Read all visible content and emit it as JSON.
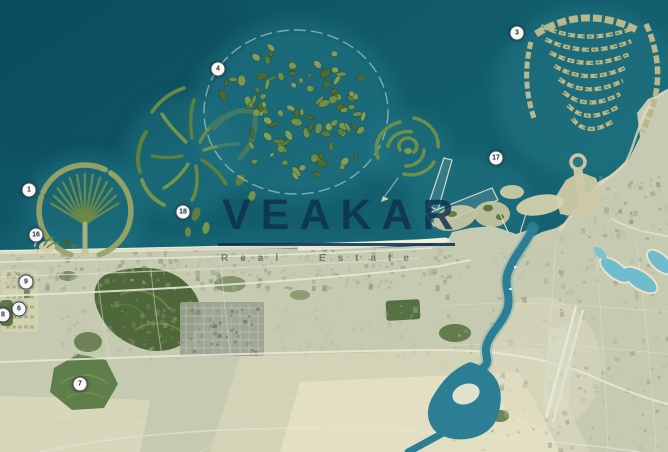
{
  "watermark": {
    "brand": "VEAKAR",
    "tagline": "Real Estate"
  },
  "markers": [
    {
      "label": "1",
      "x": 29,
      "y": 190
    },
    {
      "label": "3",
      "x": 517,
      "y": 33
    },
    {
      "label": "4",
      "x": 218,
      "y": 69
    },
    {
      "label": "6",
      "x": 19,
      "y": 309
    },
    {
      "label": "7",
      "x": 80,
      "y": 384
    },
    {
      "label": "8",
      "x": 3,
      "y": 315
    },
    {
      "label": "9",
      "x": 26,
      "y": 282
    },
    {
      "label": "16",
      "x": 36,
      "y": 235
    },
    {
      "label": "17",
      "x": 496,
      "y": 158
    },
    {
      "label": "18",
      "x": 183,
      "y": 212
    }
  ],
  "palette": {
    "sea": "#135e6d",
    "sea_deep": "#0c5060",
    "shallow_water": "#2f8b9a",
    "land": "#c6cab0",
    "beach_sand": "#ece5cb",
    "island_vegetation": "#6d8d46",
    "dark_vegetation": "#44602f",
    "urban_grey": "#9aa391",
    "creek_water": "#2c7e95",
    "lagoon_aqua": "#6fbccc",
    "watermark_navy": "#0f3151",
    "marker_bg": "#f6f8f4",
    "marker_text": "#1f2946"
  }
}
